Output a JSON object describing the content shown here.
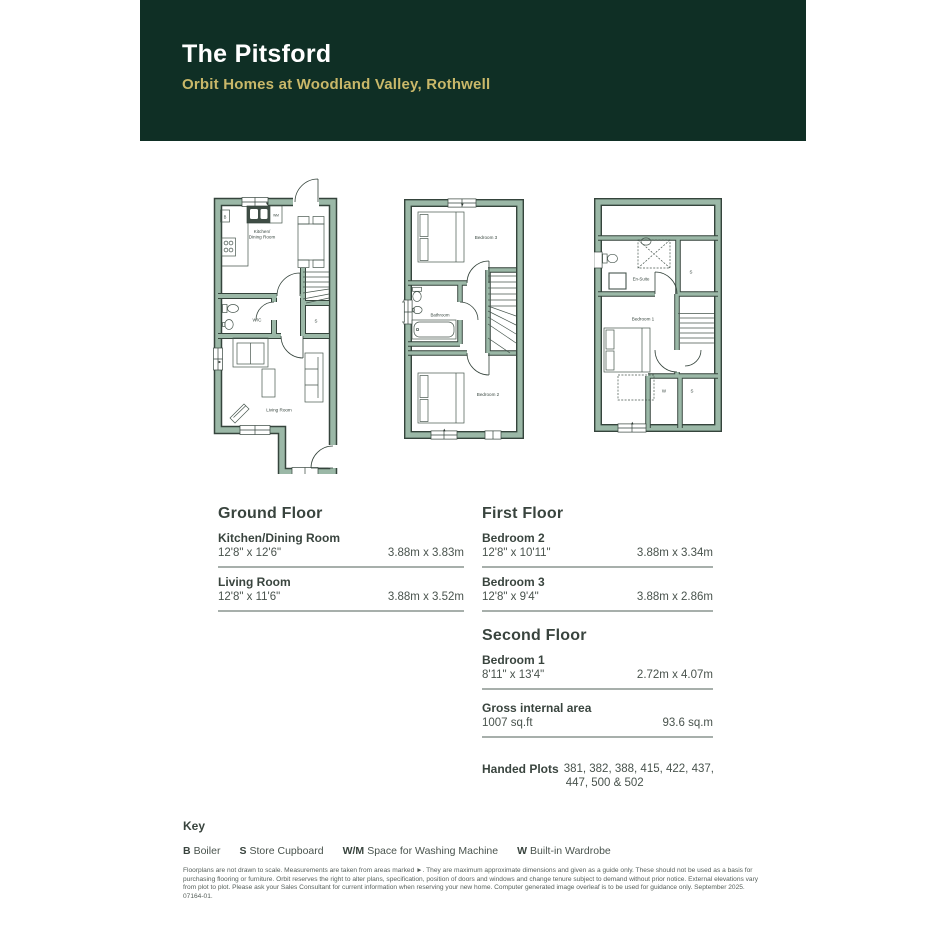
{
  "header": {
    "title": "The Pitsford",
    "subtitle": "Orbit Homes at Woodland Valley, Rothwell",
    "bg_color": "#0f2f25",
    "title_color": "#ffffff",
    "subtitle_color": "#c9b869"
  },
  "floor_plans": {
    "wall_color": "#9bb8a7",
    "line_color": "#35443c",
    "ground": {
      "labels": {
        "kitchen_line1": "Kitchen/",
        "kitchen_line2": "Dining Room",
        "wc": "W/C",
        "store": "S",
        "living": "Living Room",
        "boiler": "B",
        "washing_machine": "WM"
      }
    },
    "first": {
      "labels": {
        "bedroom3": "Bedroom 3",
        "bathroom": "Bathroom",
        "bedroom2": "Bedroom 2"
      }
    },
    "second": {
      "labels": {
        "ensuite": "En-Suite",
        "store_top": "S",
        "bedroom1": "Bedroom 1",
        "wardrobe": "W",
        "store_bottom": "S"
      }
    }
  },
  "schedule": {
    "ground_floor": {
      "title": "Ground Floor",
      "rows": [
        {
          "room": "Kitchen/Dining Room",
          "imperial": "12'8\" x 12'6\"",
          "metric": "3.88m x 3.83m"
        },
        {
          "room": "Living Room",
          "imperial": "12'8\" x 11'6\"",
          "metric": "3.88m x 3.52m"
        }
      ]
    },
    "first_floor": {
      "title": "First Floor",
      "rows": [
        {
          "room": "Bedroom 2",
          "imperial": "12'8\" x 10'11\"",
          "metric": "3.88m x 3.34m"
        },
        {
          "room": "Bedroom 3",
          "imperial": "12'8\" x 9'4\"",
          "metric": "3.88m x 2.86m"
        }
      ]
    },
    "second_floor": {
      "title": "Second Floor",
      "rows": [
        {
          "room": "Bedroom 1",
          "imperial": "8'11\" x 13'4\"",
          "metric": "2.72m x 4.07m"
        }
      ]
    },
    "gross_internal_area": {
      "label": "Gross internal area",
      "imperial": "1007 sq.ft",
      "metric": "93.6 sq.m"
    },
    "handed_plots": {
      "label": "Handed Plots",
      "line1": "381, 382, 388, 415, 422, 437,",
      "line2": "447, 500 & 502"
    }
  },
  "key": {
    "title": "Key",
    "items": [
      {
        "symbol": "B",
        "label": "Boiler"
      },
      {
        "symbol": "S",
        "label": "Store Cupboard"
      },
      {
        "symbol": "W/M",
        "label": "Space for Washing Machine"
      },
      {
        "symbol": "W",
        "label": "Built-in Wardrobe"
      }
    ]
  },
  "disclaimer": "Floorplans are not drawn to scale. Measurements are taken from areas marked ►. They are maximum approximate dimensions and given as a guide only. These should not be used as a basis for purchasing flooring or furniture. Orbit reserves the right to alter plans, specification, position of doors and windows and change tenure subject to demand without prior notice. External elevations vary from plot to plot. Please ask your Sales Consultant for current information when reserving your new home. Computer generated image overleaf is to be used for guidance only. September 2025. 07164-01."
}
